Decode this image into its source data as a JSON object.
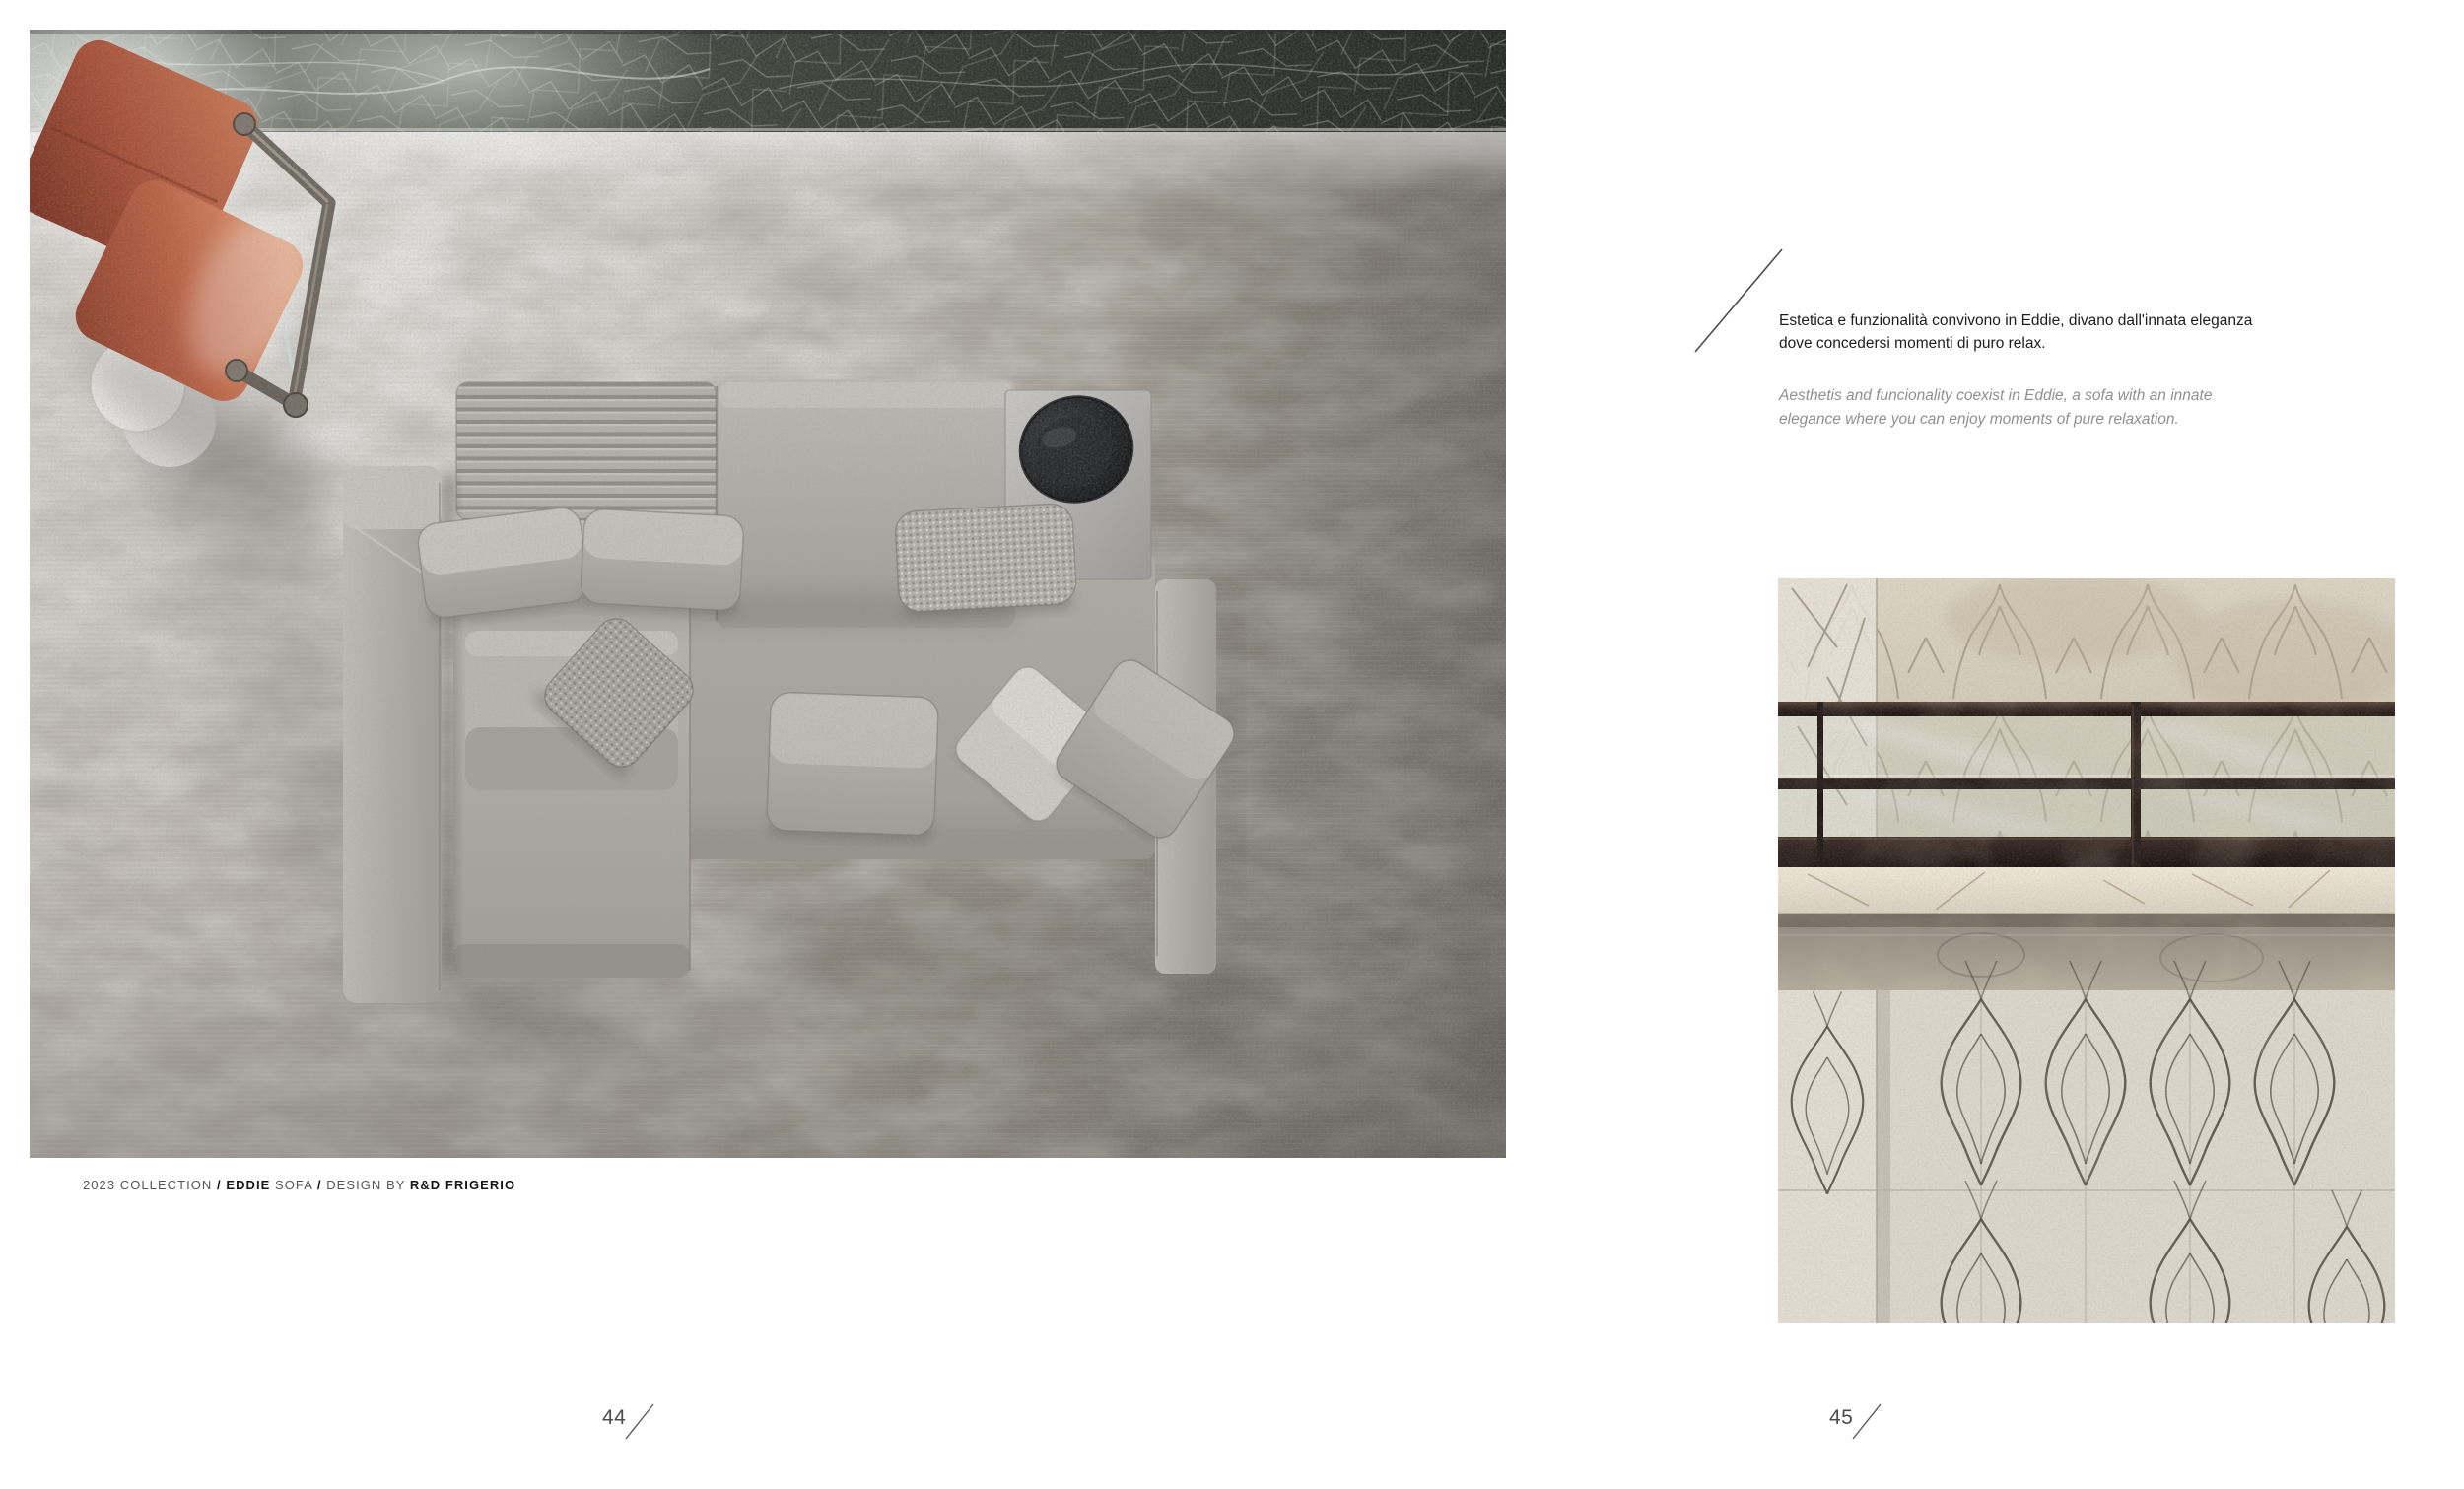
{
  "left_page": {
    "caption": {
      "collection": "2023 COLLECTION",
      "slash1": "/",
      "product_name": "EDDIE",
      "product_type": "SOFA",
      "slash2": "/",
      "design_by": "DESIGN BY",
      "designer": "R&D FRIGERIO"
    },
    "page_number": "44"
  },
  "right_page": {
    "intro_it": {
      "line1": "Estetica e funzionalità convivono in Eddie, divano dall'innata eleganza",
      "line2": "dove concedersi momenti di puro relax."
    },
    "intro_en": {
      "line1": "Aesthetis and funcionality coexist in Eddie, a sofa with an innate",
      "line2": "elegance where you can enjoy moments of pure relaxation."
    },
    "page_number": "45"
  },
  "colors": {
    "page_background": "#ffffff",
    "terracotta_chair": "#b2593f",
    "sofa_fabric": "#aaa7a1",
    "rug": "#aba79f",
    "dark_marble_band": "#31352e",
    "marble_wall": "#d4ccba",
    "railing": "#2b211d",
    "text_dark": "#1d1d1f",
    "text_gray": "#8f8f8f"
  }
}
